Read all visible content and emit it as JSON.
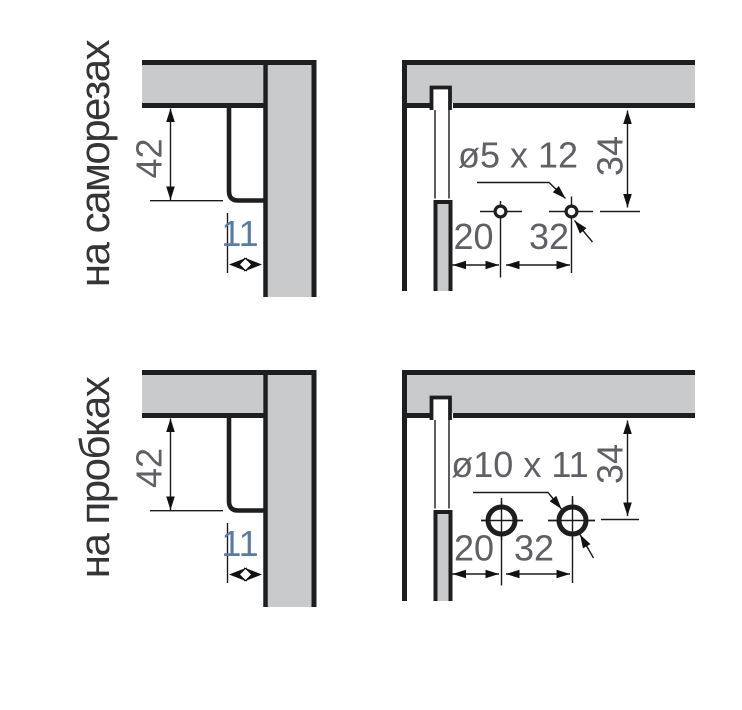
{
  "rows": [
    {
      "label": "на саморезах",
      "side_view": {
        "dim_vertical": "42",
        "dim_horizontal": "11"
      },
      "front_view": {
        "hole_label": "ø5 x 12",
        "dim_top": "34",
        "dim_left": "20",
        "dim_pitch": "32"
      }
    },
    {
      "label": "на пробках",
      "side_view": {
        "dim_vertical": "42",
        "dim_horizontal": "11"
      },
      "front_view": {
        "hole_label": "ø10 x 11",
        "dim_top": "34",
        "dim_left": "20",
        "dim_pitch": "32"
      }
    }
  ],
  "colors": {
    "panel_fill": "#c9cacc",
    "outline": "#1d1e20",
    "dim_text": "#5e6065",
    "dim_text_accent": "#5a7ca3",
    "label_text": "#353538"
  }
}
